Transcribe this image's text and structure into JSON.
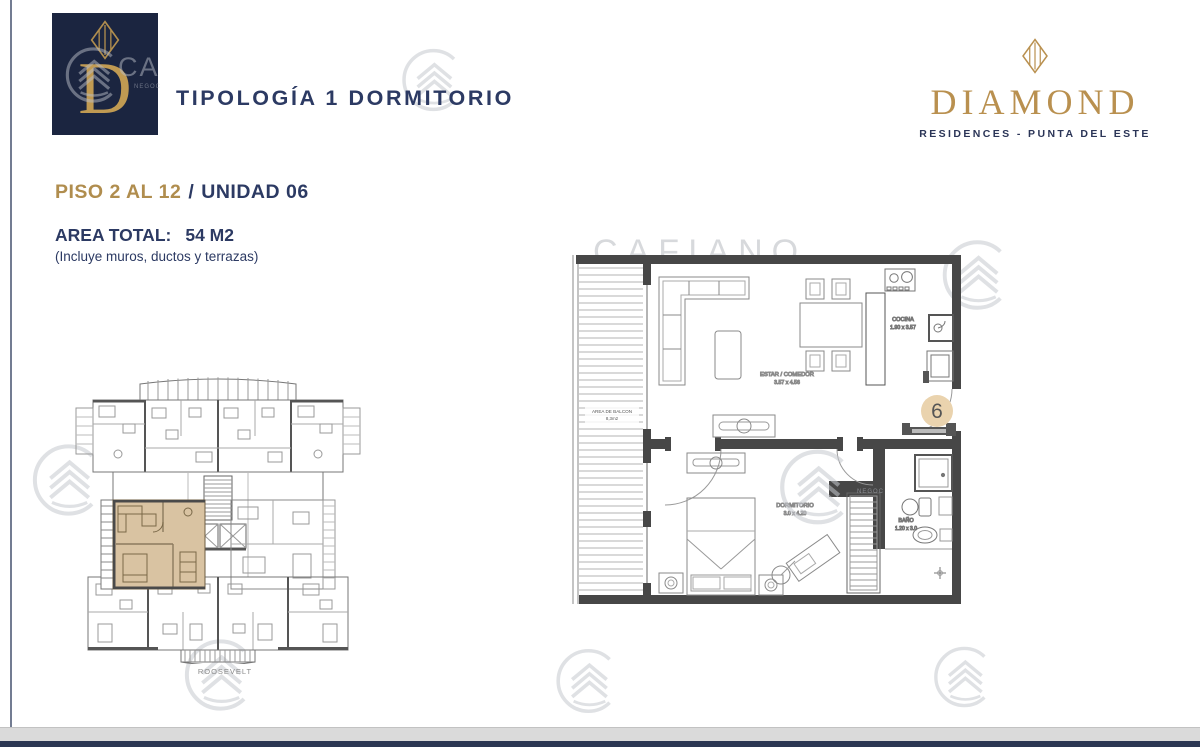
{
  "header": {
    "title": "TIPOLOGÍA 1 DORMITORIO",
    "brand_letter": "D"
  },
  "diamond_logo": {
    "name": "DIAMOND",
    "tagline": "RESIDENCES - PUNTA DEL ESTE"
  },
  "unit_info": {
    "floor_label": "PISO 2 AL 12",
    "separator": "/",
    "unit_label": "UNIDAD 06",
    "area_label": "AREA TOTAL:",
    "area_value": "54 M2",
    "area_note": "(Incluye muros, ductos y terrazas)"
  },
  "floor_plan": {
    "unit_number": "6",
    "rooms": {
      "living": {
        "label": "ESTAR / COMEDOR",
        "dims": "3.57 x 4.56"
      },
      "kitchen": {
        "label": "COCINA",
        "dims": "1.90 x 3.57"
      },
      "bedroom": {
        "label": "DORMITORIO",
        "dims": "3.0 x 4.20"
      },
      "bathroom": {
        "label": "BAÑO",
        "dims": "1.20 x 3.0"
      },
      "balcony": {
        "label": "AREA DE BALCON",
        "dims": "8,3m2"
      }
    }
  },
  "key_plan": {
    "street_label": "ROOSEVELT"
  },
  "watermark": {
    "text": "CAFIANO",
    "initials": "CA",
    "partial": "NEGOC"
  },
  "colors": {
    "navy": "#2c3a63",
    "gold": "#b08d4e",
    "logo_bg": "#1b2540",
    "wall": "#474747",
    "highlight_tan": "#d9c3a2",
    "badge_tan": "#ead3ae",
    "watermark": "#c6c9cf"
  }
}
